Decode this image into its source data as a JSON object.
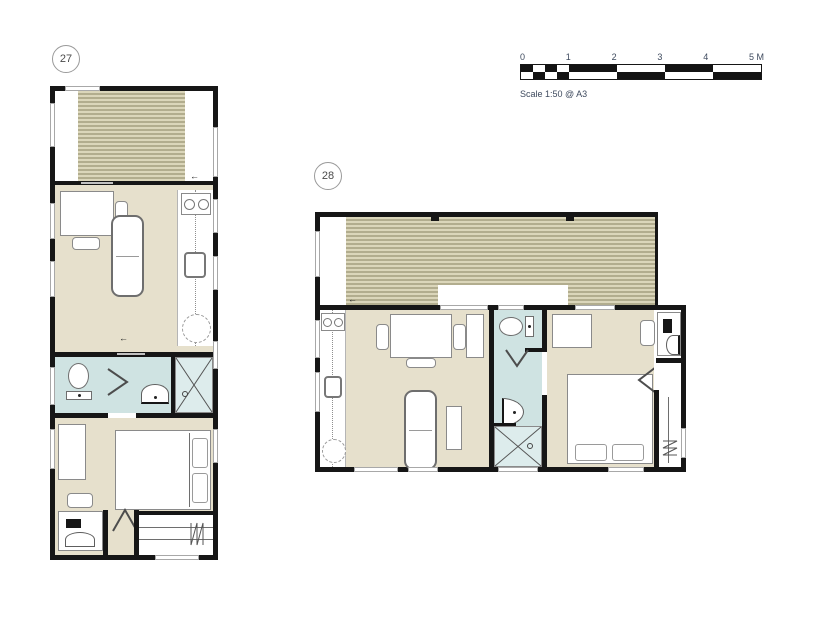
{
  "sheet": {
    "title": "Floor plans",
    "background": "#ffffff"
  },
  "plans": [
    {
      "id": "unit-27",
      "label": "27",
      "rooms": [
        "deck",
        "living-kitchen",
        "bathroom",
        "bedroom"
      ]
    },
    {
      "id": "unit-28",
      "label": "28",
      "rooms": [
        "deck",
        "living-kitchen",
        "bathroom",
        "bedroom"
      ]
    }
  ],
  "scalebar": {
    "labels": [
      "0",
      "1",
      "2",
      "3",
      "4",
      "5 M"
    ],
    "caption": "Scale 1:50 @ A3",
    "meters_total": 5
  },
  "glyphs": {
    "entry_arrow": "←"
  },
  "fixtures": [
    "deck-boards",
    "dining-table",
    "chair",
    "sofa",
    "kitchen-sink",
    "hob",
    "round-table",
    "toilet",
    "wash-basin",
    "shower",
    "door-swing",
    "bed",
    "pillows",
    "wardrobe",
    "clothes-rail",
    "dressing-table",
    "window"
  ],
  "colors": {
    "wall": "#161616",
    "floor": "#e6e0cc",
    "deck-light": "#dbd6ba",
    "deck-dark": "#b2ad8e",
    "bath": "#cfe3e2",
    "shower": "#ddecec",
    "outline": "#8a8a8a",
    "text": "#3e4a5e"
  }
}
